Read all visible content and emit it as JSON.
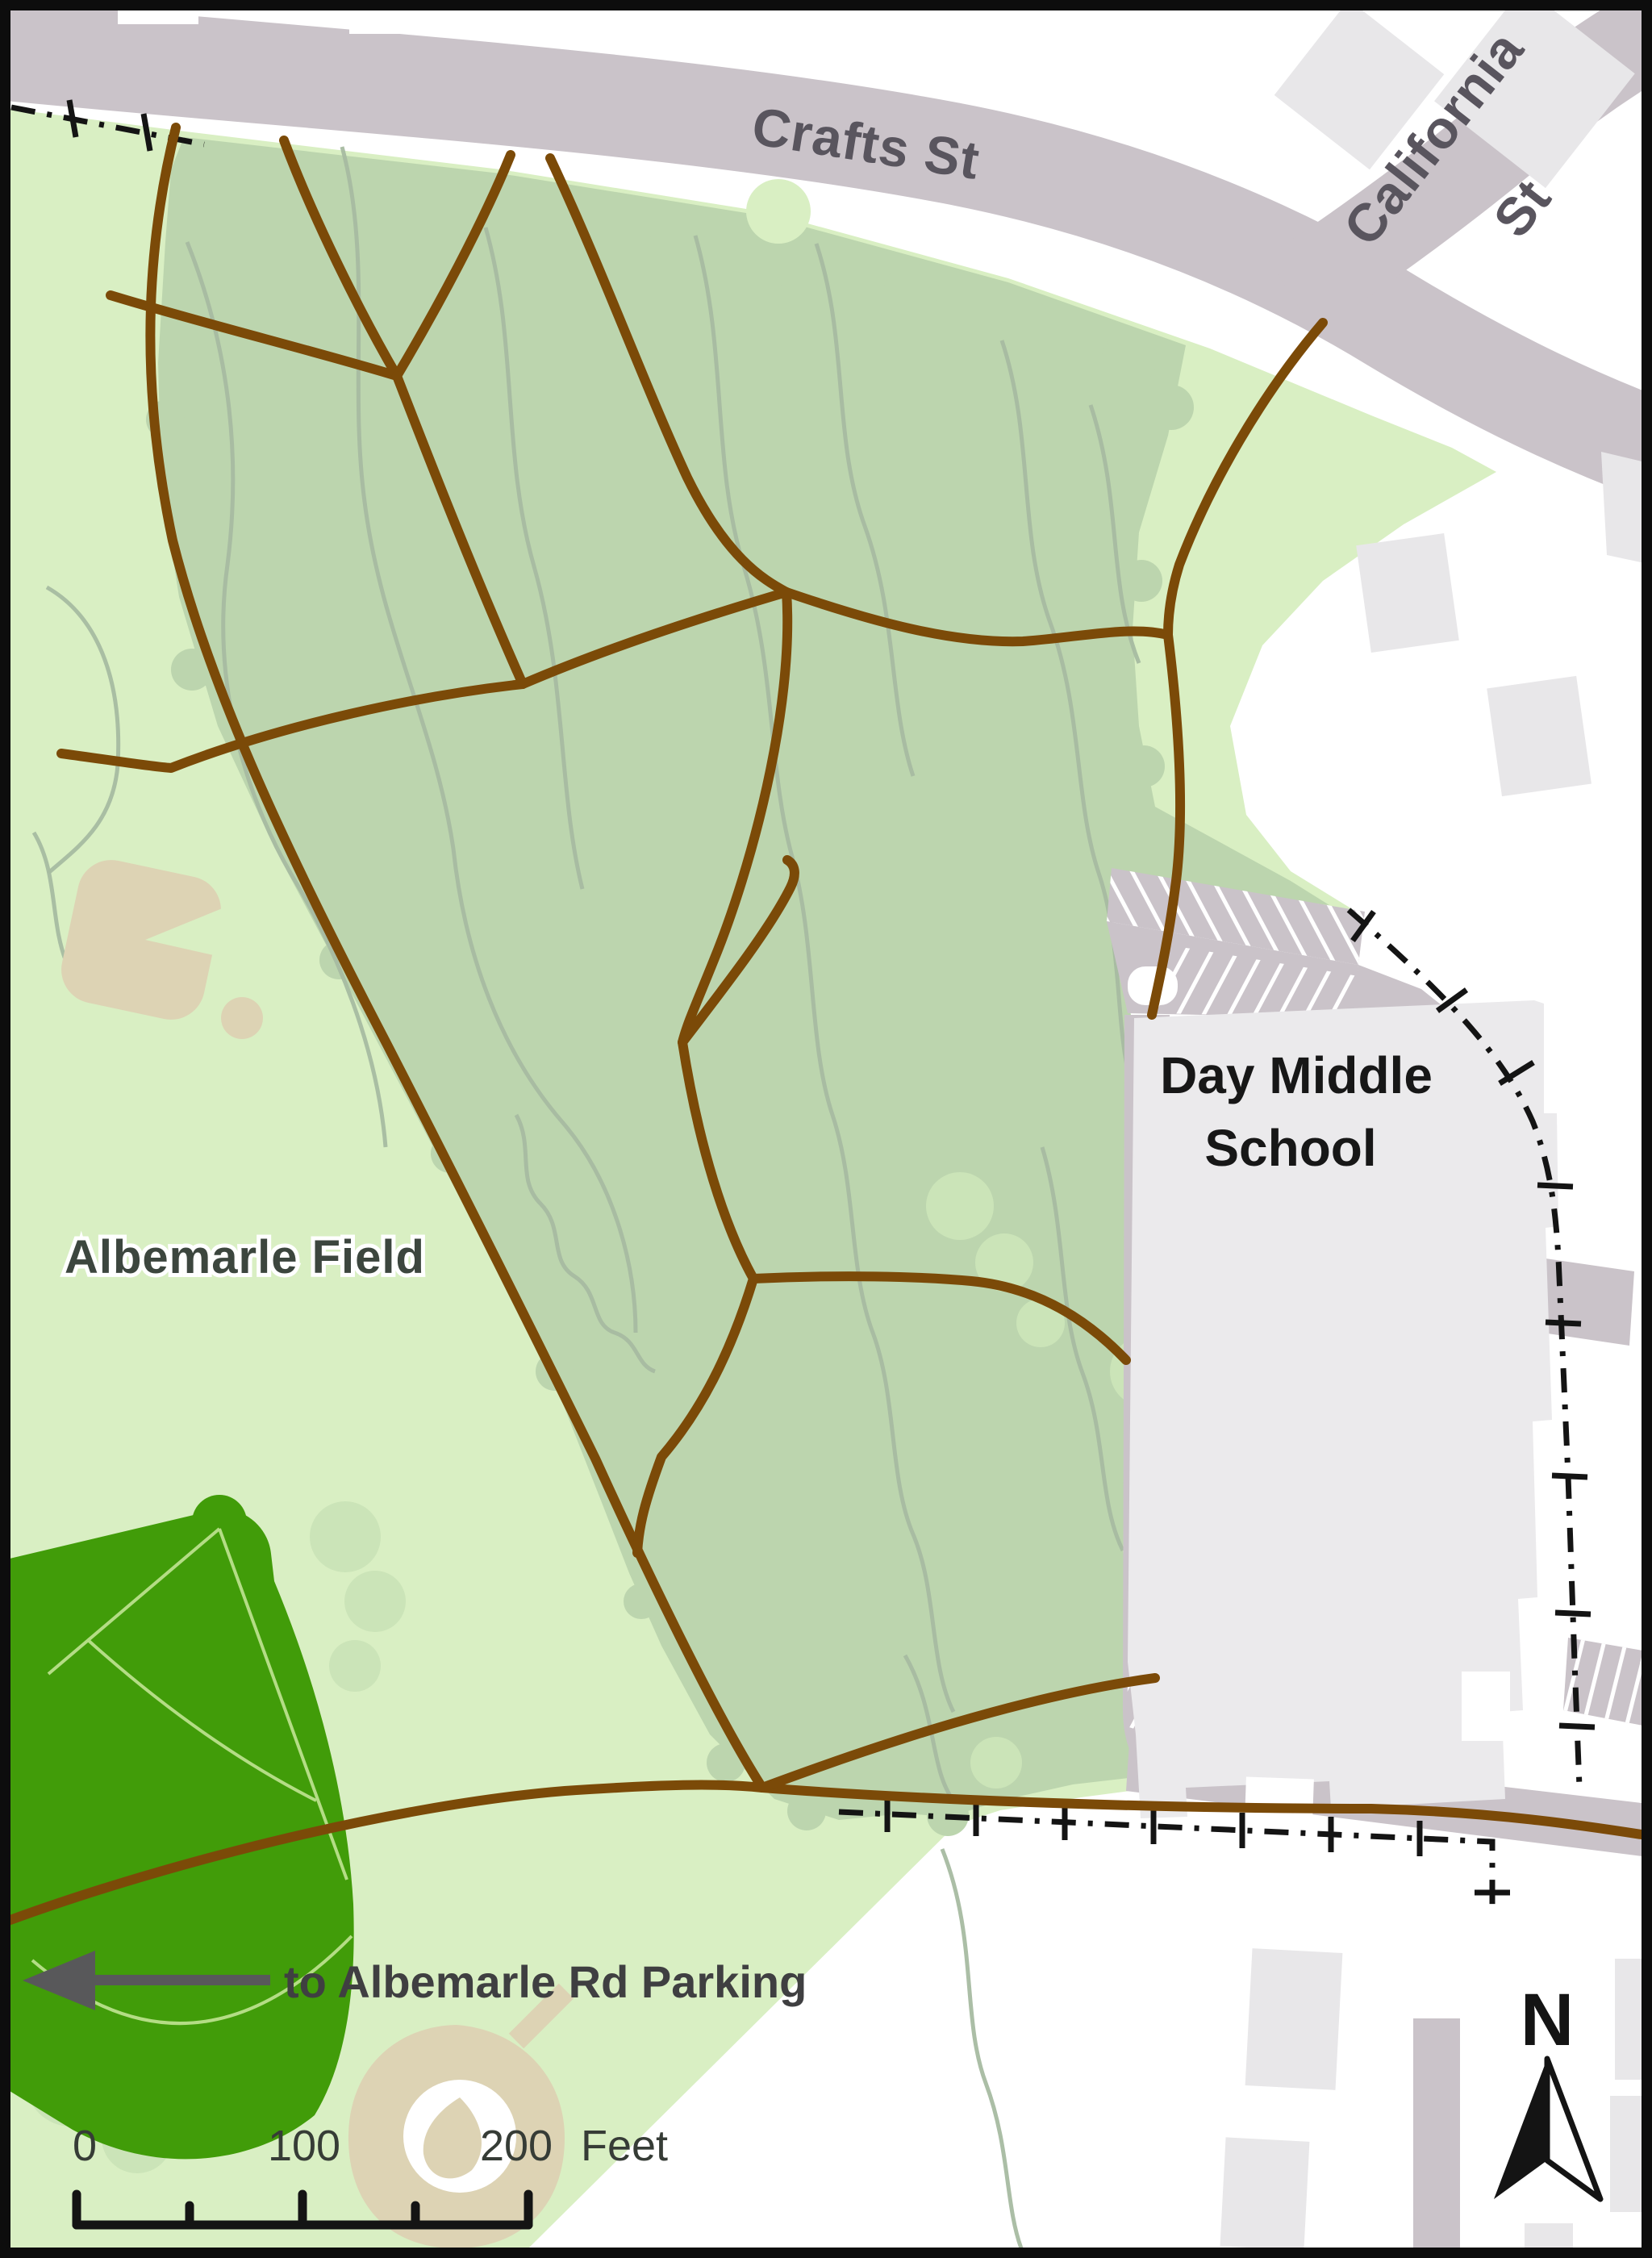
{
  "map_labels": {
    "crafts_st": "Crafts St",
    "california": "California",
    "california_suffix": "St",
    "school_line1": "Day Middle",
    "school_line2": "School",
    "albemarle_field": "Albemarle Field",
    "parking_direction": "to Albemarle Rd Parking",
    "north_indicator": "N"
  },
  "scale_bar": {
    "tick_start": "0",
    "tick_mid": "100",
    "tick_end": "200",
    "unit": "Feet"
  },
  "icons": {
    "north_arrow": "compass-north-arrow",
    "direction_arrow": "left-arrow"
  },
  "colors": {
    "park": "#d9efc3",
    "forest": "#bcd5ae",
    "canopy": "#cbe4b8",
    "contour": "#a6bba1",
    "trail": "#7b4a08",
    "road": "#cac3c9",
    "bg_building": "#e8e7e9",
    "school_building": "#ebeaec",
    "field": "#419c09",
    "field_line": "#b4dd85",
    "diamond_tan": "#ddd3b4",
    "boundary": "#141414",
    "street_label": "#59555e",
    "school_label": "#171717",
    "field_label": "#3c463e",
    "note_label": "#3f3f41",
    "arrow_gray": "#58585a",
    "scale_label": "#363c36",
    "frame": "#0d0d0d"
  }
}
